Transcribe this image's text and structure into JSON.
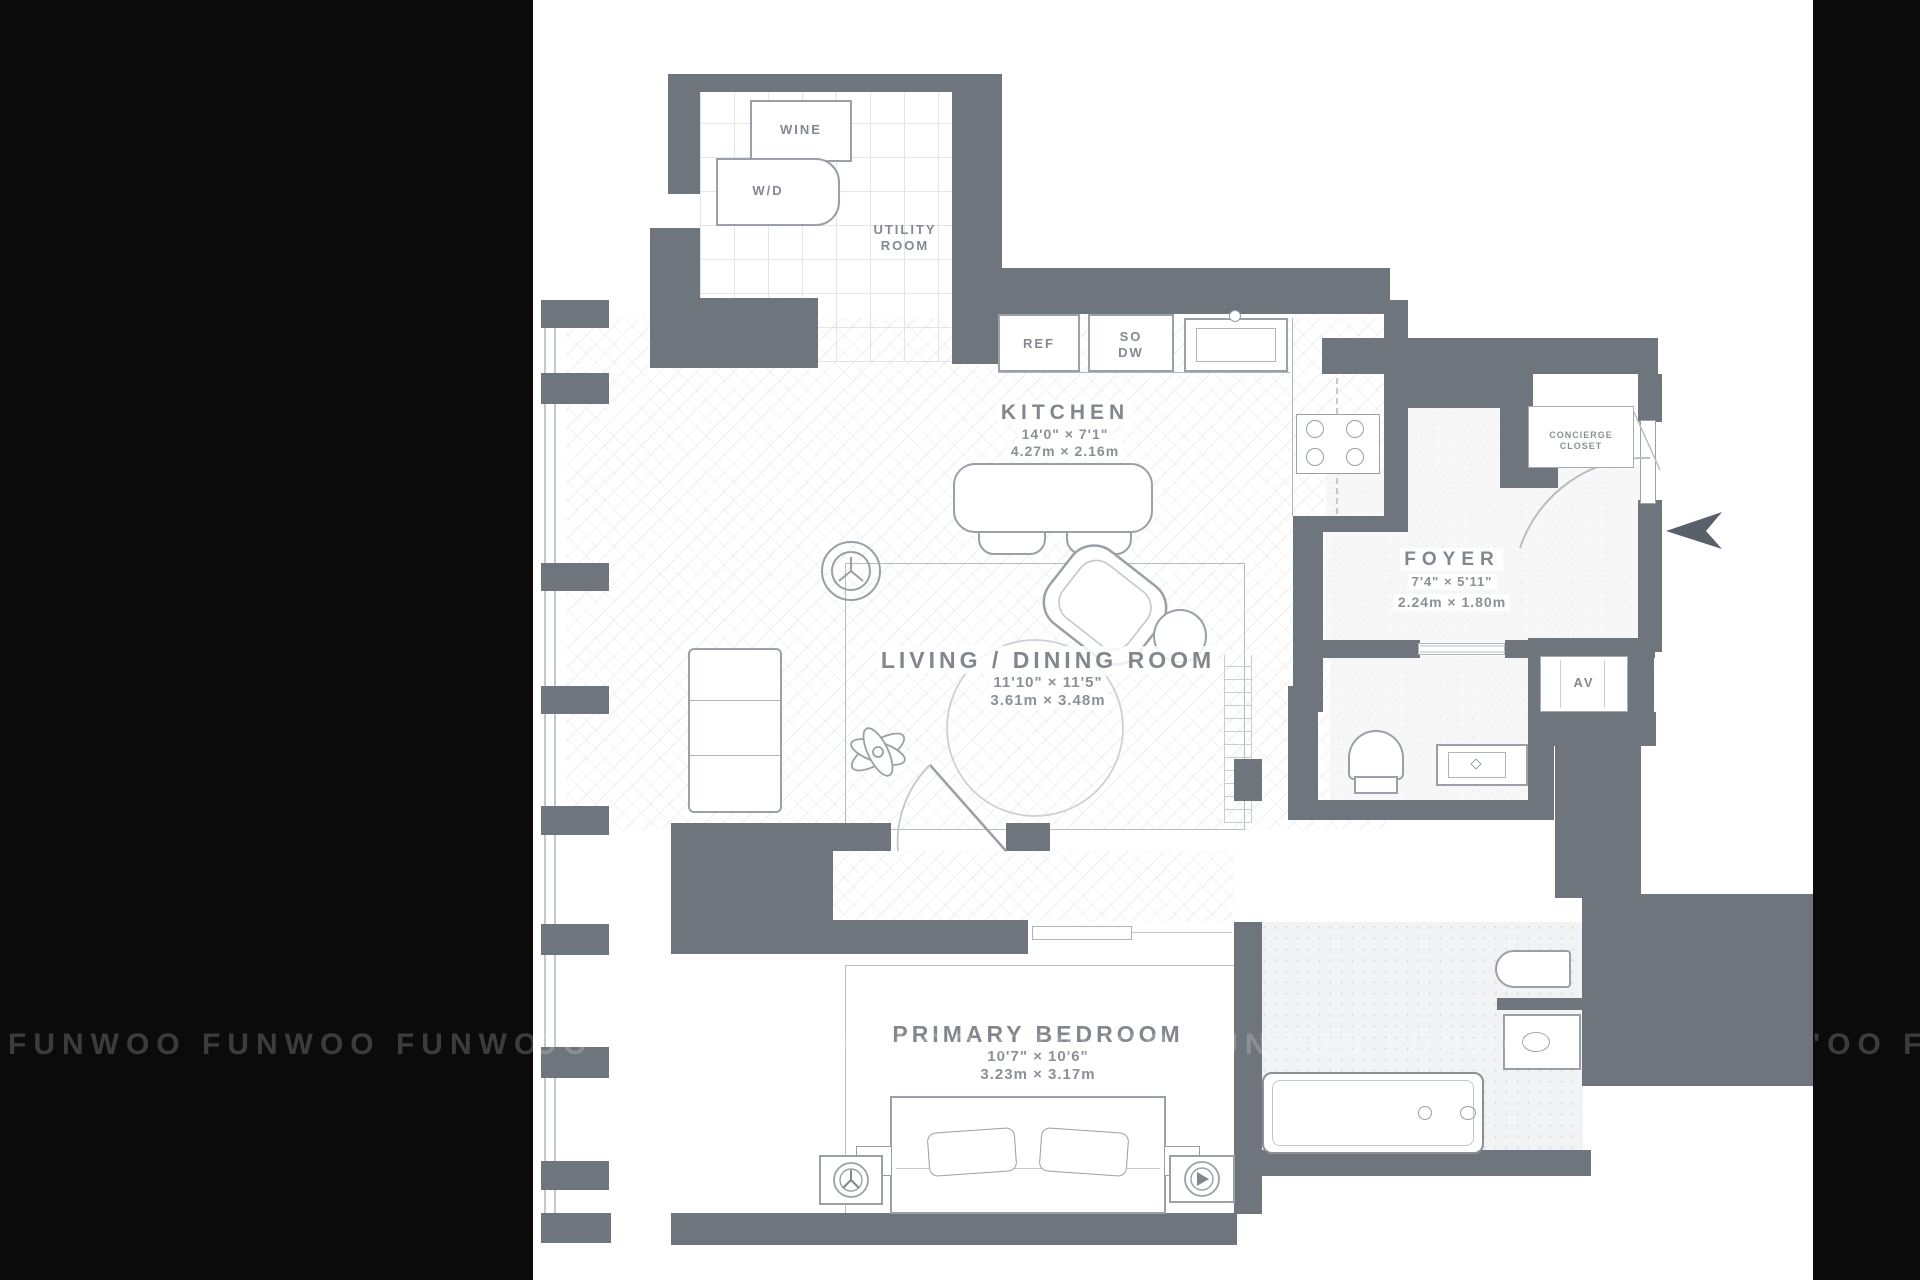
{
  "watermark": {
    "word": "FUNWOO",
    "left_text": "FUNWOO FUNWOO FUNWOO FUNW",
    "right_text": "'OO FU",
    "mid_text": "OO FUNWOO FUNWOO FUNWOO FUNWOO FUNWOO"
  },
  "rooms": {
    "kitchen": {
      "name": "KITCHEN",
      "imperial": "14'0\" × 7'1\"",
      "metric": "4.27m × 2.16m"
    },
    "living": {
      "name": "LIVING / DINING ROOM",
      "imperial": "11'10\" × 11'5\"",
      "metric": "3.61m × 3.48m"
    },
    "bedroom": {
      "name": "PRIMARY BEDROOM",
      "imperial": "10'7\" × 10'6\"",
      "metric": "3.23m × 3.17m"
    },
    "foyer": {
      "name": "FOYER",
      "imperial": "7'4\" × 5'11\"",
      "metric": "2.24m × 1.80m"
    },
    "utility": {
      "name": "UTILITY\nROOM"
    },
    "concierge": {
      "name": "CONCIERGE\nCLOSET"
    },
    "av": {
      "name": "AV"
    }
  },
  "fixtures": {
    "wine": "WINE",
    "wd": "W/D",
    "ref": "REF",
    "sodw": "SO\nDW"
  },
  "colors": {
    "wall": "#6e757d",
    "outline": "#9aa0a6",
    "label": "#82878e",
    "black_bar": "#0b0b0b",
    "watermark": "#3c3c3c",
    "entry_arrow": "#5a6069"
  }
}
